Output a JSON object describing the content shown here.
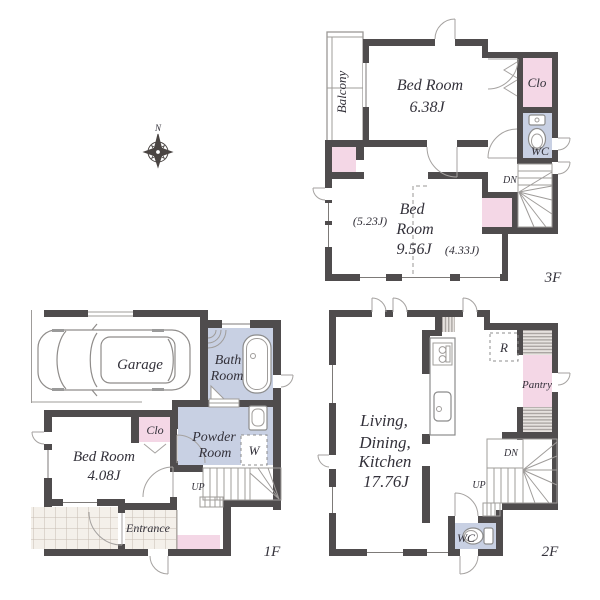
{
  "compass": {
    "north": "N"
  },
  "colors": {
    "wall": "#4f4c4d",
    "closet_pink": "#f4d7e6",
    "wet_area_blue": "#c8d0e3",
    "text": "#33313a",
    "fixture_line": "#8c8c8c"
  },
  "floor3": {
    "label": "3F",
    "balcony": "Balcony",
    "bedroom1_name": "Bed Room",
    "bedroom1_size": "6.38J",
    "closet": "Clo",
    "wc": "WC",
    "dn": "DN",
    "bedroom2_line1": "Bed",
    "bedroom2_line2": "Room",
    "bedroom2_size": "9.56J",
    "bedroom2_sub_left": "(5.23J)",
    "bedroom2_sub_right": "(4.33J)"
  },
  "floor2": {
    "label": "2F",
    "ldk_line1": "Living,",
    "ldk_line2": "Dining,",
    "ldk_line3": "Kitchen",
    "ldk_size": "17.76J",
    "fridge": "R",
    "pantry": "Pantry",
    "dn": "DN",
    "up": "UP",
    "wc": "WC"
  },
  "floor1": {
    "label": "1F",
    "garage": "Garage",
    "bath_line1": "Bath",
    "bath_line2": "Room",
    "closet": "Clo",
    "bedroom_name": "Bed Room",
    "bedroom_size": "4.08J",
    "powder_line1": "Powder",
    "powder_line2": "Room",
    "washer": "W",
    "up": "UP",
    "entrance": "Entrance"
  }
}
